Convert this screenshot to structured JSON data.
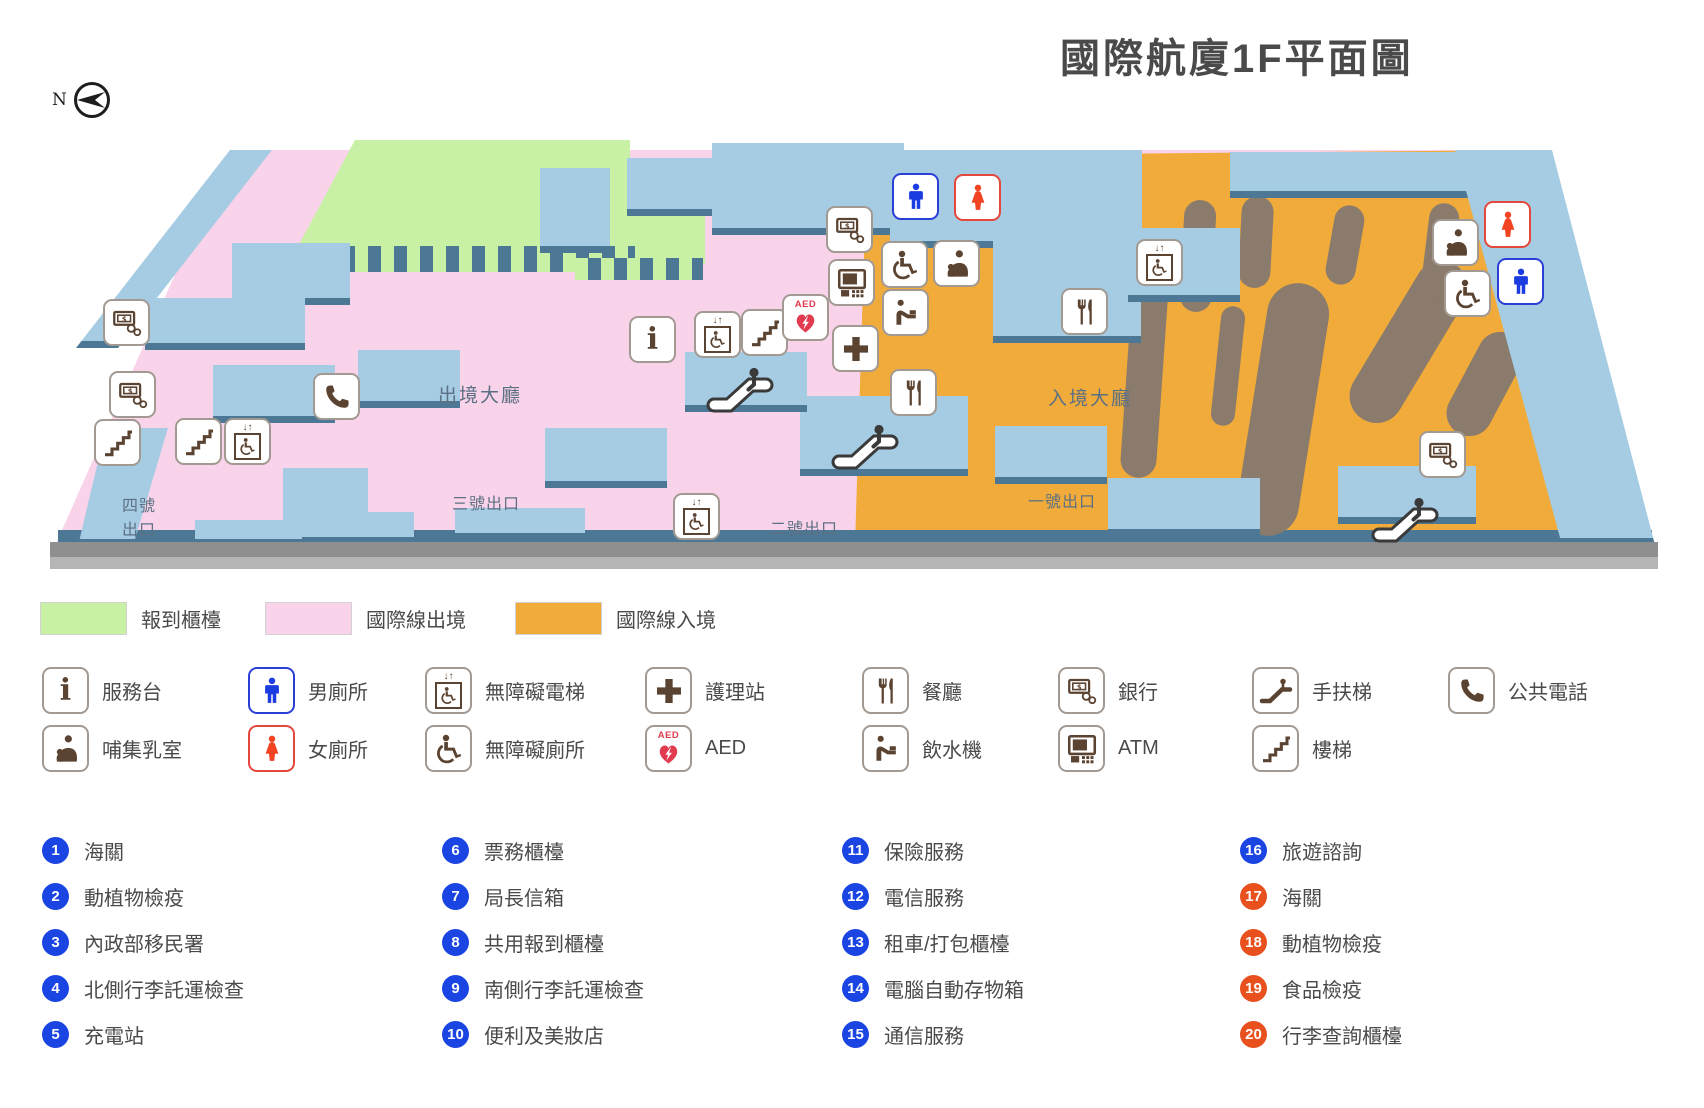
{
  "title": "國際航廈1F平面圖",
  "compass_label": "N",
  "colors": {
    "checkin_green": "#c9f1a5",
    "departure_pink": "#f8d3e9",
    "arrival_orange": "#f0ab3a",
    "wall_blue": "#a5cce3",
    "wall_edge": "#4c7795",
    "carousel_brown": "#8b7b6c",
    "badge_blue": "#1b45e2",
    "badge_orange": "#e8511d",
    "icon_brown": "#5b4332",
    "male_blue": "#1a3ce0",
    "female_red": "#f04423",
    "aed_red": "#e23a4e"
  },
  "map": {
    "hall_labels": [
      {
        "text": "出境大廳",
        "x": 480,
        "y": 394
      },
      {
        "text": "入境大廳",
        "x": 1090,
        "y": 397
      }
    ],
    "exit_labels": [
      {
        "text": "四號",
        "x": 122,
        "y": 492
      },
      {
        "text": "出口",
        "x": 122,
        "y": 516
      },
      {
        "text": "三號出口",
        "x": 452,
        "y": 490
      },
      {
        "text": "二號出口",
        "x": 770,
        "y": 515
      },
      {
        "text": "一號出口",
        "x": 1028,
        "y": 488
      }
    ],
    "icons": [
      {
        "name": "bank-icon",
        "x": 127,
        "y": 323
      },
      {
        "name": "bank-icon",
        "x": 133,
        "y": 395
      },
      {
        "name": "public-phone-icon",
        "x": 337,
        "y": 397
      },
      {
        "name": "stairs-icon",
        "x": 118,
        "y": 443
      },
      {
        "name": "stairs-icon",
        "x": 199,
        "y": 442
      },
      {
        "name": "accessible-elevator-icon",
        "x": 248,
        "y": 442
      },
      {
        "name": "info-icon",
        "x": 653,
        "y": 340
      },
      {
        "name": "accessible-elevator-icon",
        "x": 718,
        "y": 335
      },
      {
        "name": "stairs-icon",
        "x": 765,
        "y": 333
      },
      {
        "name": "aed-icon",
        "x": 806,
        "y": 318
      },
      {
        "name": "nurse-station-icon",
        "x": 856,
        "y": 349
      },
      {
        "name": "bank-icon",
        "x": 850,
        "y": 230
      },
      {
        "name": "atm-icon",
        "x": 852,
        "y": 283
      },
      {
        "name": "accessible-toilet-icon",
        "x": 905,
        "y": 265
      },
      {
        "name": "nursing-room-icon",
        "x": 957,
        "y": 264
      },
      {
        "name": "water-fountain-icon",
        "x": 906,
        "y": 313
      },
      {
        "name": "male-toilet-icon",
        "x": 916,
        "y": 197
      },
      {
        "name": "female-toilet-icon",
        "x": 978,
        "y": 198
      },
      {
        "name": "restaurant-icon",
        "x": 914,
        "y": 393
      },
      {
        "name": "restaurant-icon",
        "x": 1085,
        "y": 312
      },
      {
        "name": "accessible-elevator-icon",
        "x": 1160,
        "y": 263
      },
      {
        "name": "accessible-elevator-icon",
        "x": 697,
        "y": 517
      },
      {
        "name": "nursing-room-icon",
        "x": 1456,
        "y": 243
      },
      {
        "name": "female-toilet-icon",
        "x": 1508,
        "y": 225
      },
      {
        "name": "accessible-toilet-icon",
        "x": 1468,
        "y": 294
      },
      {
        "name": "male-toilet-icon",
        "x": 1521,
        "y": 282
      },
      {
        "name": "bank-icon",
        "x": 1443,
        "y": 455
      },
      {
        "name": "escalator-icon",
        "x": 740,
        "y": 390
      },
      {
        "name": "escalator-icon",
        "x": 865,
        "y": 447
      },
      {
        "name": "escalator-icon",
        "x": 1405,
        "y": 520
      }
    ]
  },
  "area_legend": [
    {
      "label": "報到櫃檯",
      "color": "#c9f1a5"
    },
    {
      "label": "國際線出境",
      "color": "#f8d3e9"
    },
    {
      "label": "國際線入境",
      "color": "#f0ab3a"
    }
  ],
  "icon_legend": [
    [
      {
        "icon": "info-icon",
        "label": "服務台"
      },
      {
        "icon": "nursing-room-icon",
        "label": "哺集乳室"
      }
    ],
    [
      {
        "icon": "male-toilet-icon",
        "label": "男廁所"
      },
      {
        "icon": "female-toilet-icon",
        "label": "女廁所"
      }
    ],
    [
      {
        "icon": "accessible-elevator-icon",
        "label": "無障礙電梯"
      },
      {
        "icon": "accessible-toilet-icon",
        "label": "無障礙廁所"
      }
    ],
    [
      {
        "icon": "nurse-station-icon",
        "label": "護理站"
      },
      {
        "icon": "aed-icon",
        "label": "AED"
      }
    ],
    [
      {
        "icon": "restaurant-icon",
        "label": "餐廳"
      },
      {
        "icon": "water-fountain-icon",
        "label": "飲水機"
      }
    ],
    [
      {
        "icon": "bank-icon",
        "label": "銀行"
      },
      {
        "icon": "atm-icon",
        "label": "ATM"
      }
    ],
    [
      {
        "icon": "escalator-icon",
        "label": "手扶梯"
      },
      {
        "icon": "stairs-icon",
        "label": "樓梯"
      }
    ],
    [
      {
        "icon": "public-phone-icon",
        "label": "公共電話"
      }
    ]
  ],
  "numbered_legend": [
    [
      {
        "num": "1",
        "label": "海關",
        "color": "#1b45e2"
      },
      {
        "num": "2",
        "label": "動植物檢疫",
        "color": "#1b45e2"
      },
      {
        "num": "3",
        "label": "內政部移民署",
        "color": "#1b45e2"
      },
      {
        "num": "4",
        "label": "北側行李託運檢查",
        "color": "#1b45e2"
      },
      {
        "num": "5",
        "label": "充電站",
        "color": "#1b45e2"
      }
    ],
    [
      {
        "num": "6",
        "label": "票務櫃檯",
        "color": "#1b45e2"
      },
      {
        "num": "7",
        "label": "局長信箱",
        "color": "#1b45e2"
      },
      {
        "num": "8",
        "label": "共用報到櫃檯",
        "color": "#1b45e2"
      },
      {
        "num": "9",
        "label": "南側行李託運檢查",
        "color": "#1b45e2"
      },
      {
        "num": "10",
        "label": "便利及美妝店",
        "color": "#1b45e2"
      }
    ],
    [
      {
        "num": "11",
        "label": "保險服務",
        "color": "#1b45e2"
      },
      {
        "num": "12",
        "label": "電信服務",
        "color": "#1b45e2"
      },
      {
        "num": "13",
        "label": "租車/打包櫃檯",
        "color": "#1b45e2"
      },
      {
        "num": "14",
        "label": "電腦自動存物箱",
        "color": "#1b45e2"
      },
      {
        "num": "15",
        "label": "通信服務",
        "color": "#1b45e2"
      }
    ],
    [
      {
        "num": "16",
        "label": "旅遊諮詢",
        "color": "#1b45e2"
      },
      {
        "num": "17",
        "label": "海關",
        "color": "#e8511d"
      },
      {
        "num": "18",
        "label": "動植物檢疫",
        "color": "#e8511d"
      },
      {
        "num": "19",
        "label": "食品檢疫",
        "color": "#e8511d"
      },
      {
        "num": "20",
        "label": "行李查詢櫃檯",
        "color": "#e8511d"
      }
    ]
  ]
}
